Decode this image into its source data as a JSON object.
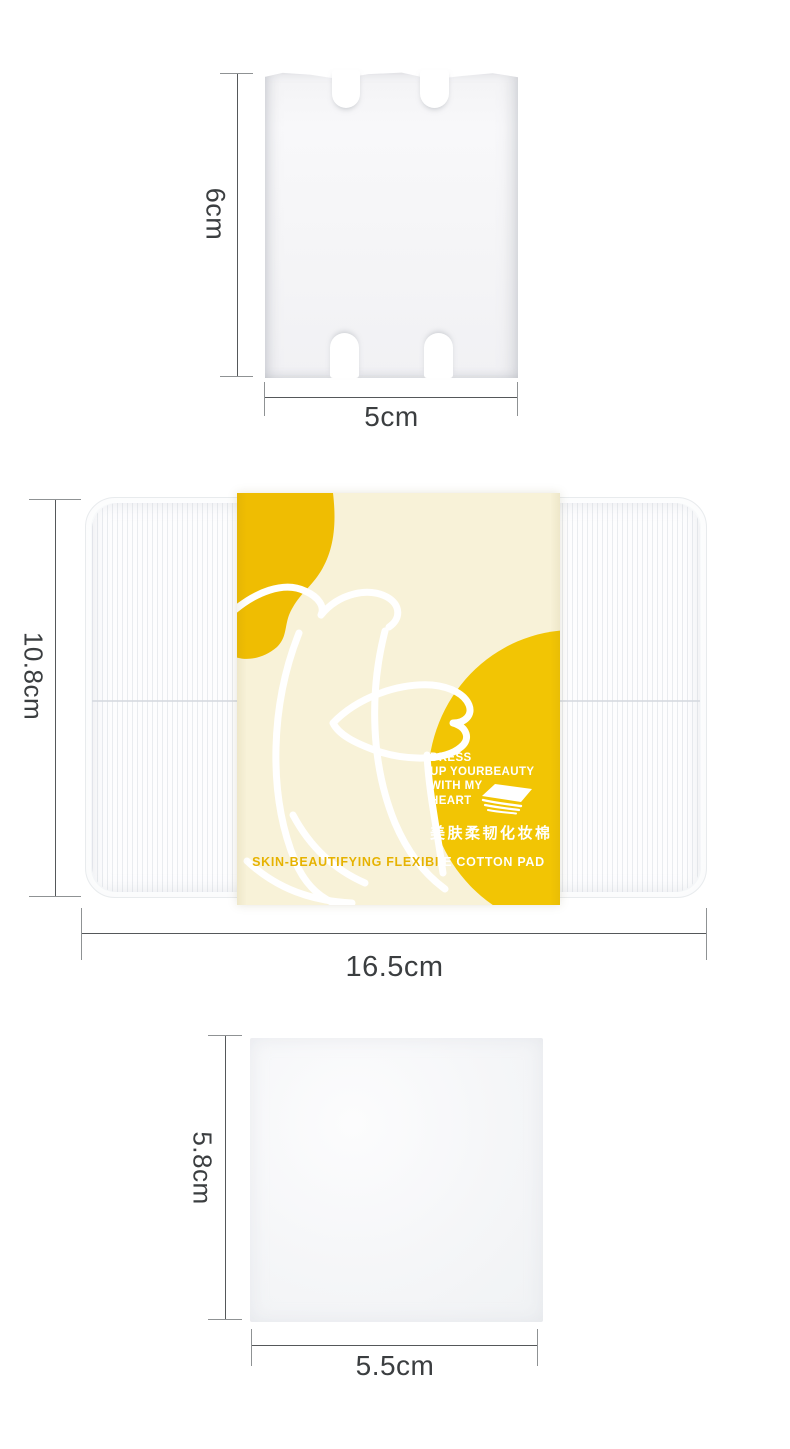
{
  "measurements": {
    "pad_single": {
      "height": "6cm",
      "width": "5cm"
    },
    "package": {
      "height": "10.8cm",
      "width": "16.5cm"
    },
    "pad_square": {
      "height": "5.8cm",
      "width": "5.5cm"
    }
  },
  "package_label": {
    "slogan": [
      "DRESS",
      "UP YOURBEAUTY",
      "WITH MY",
      "HEART"
    ],
    "product_name_cn": "美肤柔韧化妆棉",
    "product_name_en": "SKIN-BEAUTIFYING FLEXIBLE COTTON PAD"
  },
  "colors": {
    "page_bg": "#FFFFFF",
    "label_yellow": "#F2C504",
    "label_blob_yellow": "#EFBD02",
    "label_cream": "#F8F2D8",
    "label_text_yellow": "#E6B200",
    "dimension_line": "#55585A",
    "dimension_cap": "#8F9294",
    "dimension_text": "#3B3E40"
  }
}
